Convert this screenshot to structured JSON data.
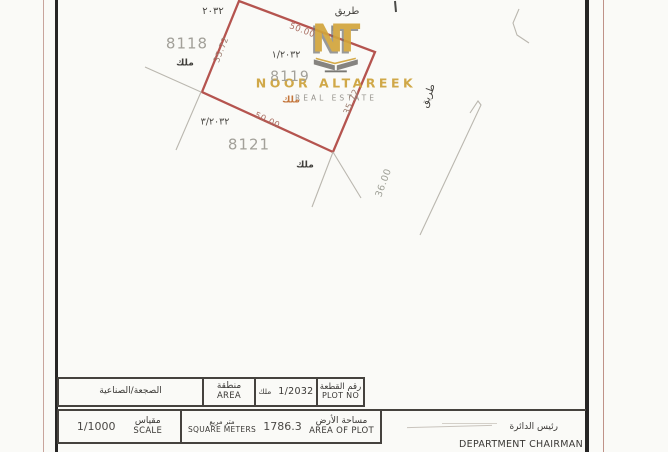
{
  "document": {
    "watermark": {
      "logo": "NT",
      "brand": "NOOR ALTAREEK",
      "tagline": "REAL ESTATE"
    },
    "map": {
      "block_number": "٢٠٣٢",
      "road_top": "طريق",
      "road_right": "طريق",
      "plot_8118": "8118",
      "plot_8119": "8119",
      "plot_8121": "8121",
      "ownership_8118": "ملك",
      "ownership_8119": "ملك",
      "ownership_8121": "ملك",
      "parcel_ref_1": "١/٢٠٣٢",
      "parcel_ref_3": "٣/٢٠٣٢",
      "dim_top": "50.00",
      "dim_bottom": "50.00",
      "dim_left": "35.72",
      "dim_right": "35.72",
      "dim_road": "36.00"
    },
    "table": {
      "area_value": "الصجعة/الصناعية",
      "area_label_ar": "منطقة",
      "area_label_en": "AREA",
      "ownership": "ملك",
      "plot_no_value": "1/2032",
      "plot_no_label_ar": "رقم القطعة",
      "plot_no_label_en": "PLOT NO",
      "scale_value": "1/1000",
      "scale_label_ar": "مقياس",
      "scale_label_en": "SCALE",
      "units_ar": "متر مربع",
      "units_en": "SQUARE METERS",
      "plot_area_value": "1786.3",
      "plot_area_label_ar": "مساحة الأرض",
      "plot_area_label_en": "AREA OF PLOT",
      "chairman_ar": "رئيس الدائرة",
      "chairman_en": "DEPARTMENT CHAIRMAN"
    },
    "colors": {
      "plot_outline": "#b5544f",
      "watermark_gold": "#d2a53c",
      "faint_line": "#b9b6ae",
      "paper": "#faf9f6",
      "table_line": "#45423e"
    }
  }
}
